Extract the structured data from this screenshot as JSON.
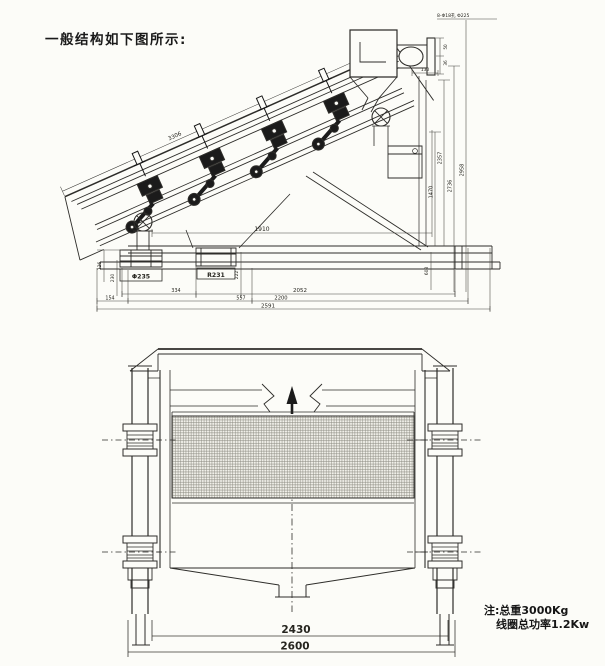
{
  "colors": {
    "paper": "#fcfcf8",
    "ink": "#2e2d2a",
    "dim_ink": "#45443f"
  },
  "caption": "一般结构如下图所示:",
  "note": {
    "line1": "注:总重3000Kg",
    "line2": "线圈总功率1.2Kw"
  },
  "side_view": {
    "hole_note": "8-Φ18孔 Φ225",
    "boxed_labels": {
      "left_foot": "Φ235",
      "spout": "R231"
    },
    "dims": {
      "incline_length": "3306",
      "mid_span": "1910",
      "bracket_width": "130",
      "feed_height_a": "50",
      "feed_height_b": "36",
      "right_h1": "1470",
      "right_h2": "2357",
      "right_h3": "2736",
      "right_h4": "2958",
      "base_height": "608",
      "left_h1": "126",
      "left_h2": "230",
      "spout_height": "222",
      "b_154": "154",
      "b_334": "334",
      "b_557": "557",
      "b_2052": "2052",
      "b_2200": "2200",
      "b_2591": "2591"
    }
  },
  "front_view": {
    "dims": {
      "inner_width": "2430",
      "outer_width": "2600"
    }
  }
}
